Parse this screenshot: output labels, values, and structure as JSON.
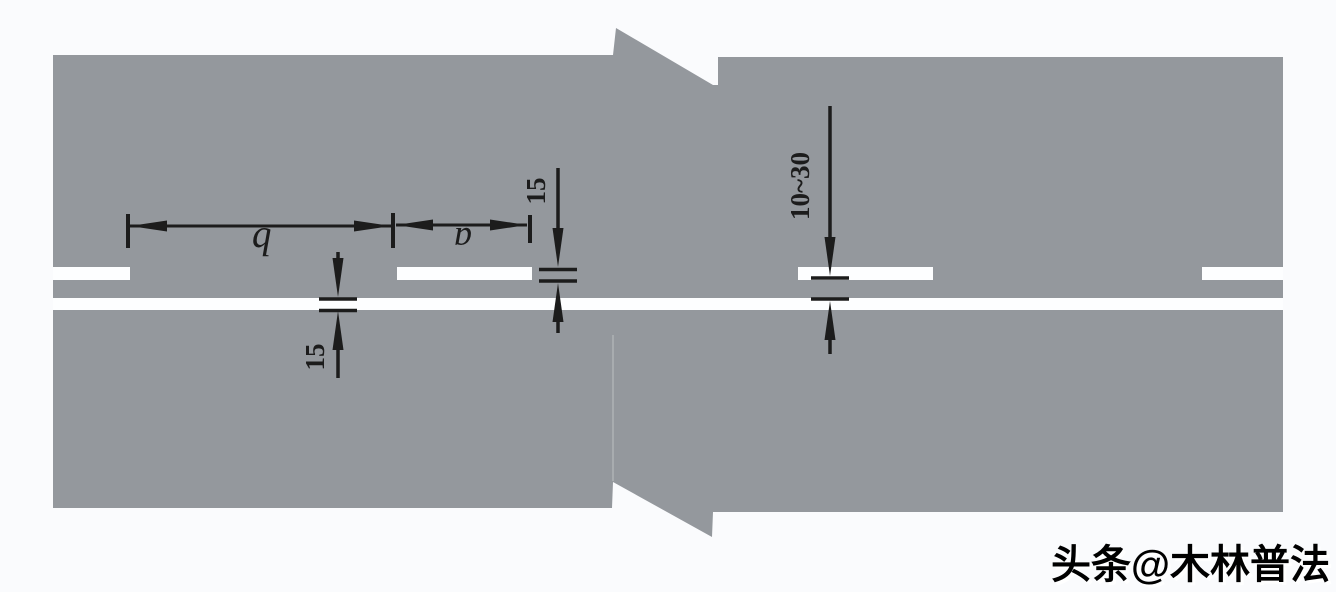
{
  "figure": {
    "type": "road-lane-marking-dimension-diagram",
    "annotations": {
      "gap_length_label": "b",
      "segment_length_label": "a",
      "dashed_line_width": "15",
      "solid_line_width": "15",
      "line_spacing_range": "10~30"
    },
    "watermark": {
      "text": "头条@木林普法"
    },
    "colors": {
      "background": "#fafbfd",
      "road_surface": "#94989d",
      "lane_marking": "#fdfeff",
      "dimension_ink": "#1c1c1c"
    }
  }
}
